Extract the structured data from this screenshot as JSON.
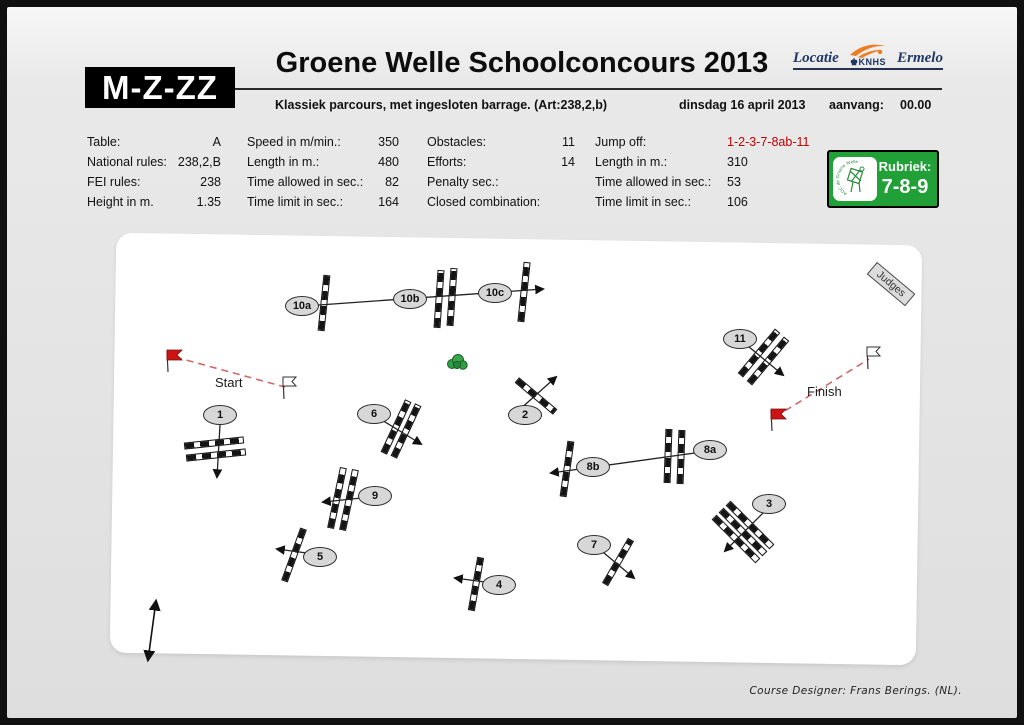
{
  "header": {
    "class_box": "M-Z-ZZ",
    "title": "Groene Welle Schoolconcours 2013",
    "location": {
      "prefix": "Locatie",
      "org": "KNHS",
      "city": "Ermelo"
    },
    "subtitle": "Klassiek parcours, met ingesloten barrage. (Art:238,2,b)",
    "date": "dinsdag 16 april 2013",
    "start_time_label": "aanvang:",
    "start_time_value": "00.00"
  },
  "info_table": {
    "columns": [
      {
        "rows": [
          {
            "label": "Table:",
            "value": "A"
          },
          {
            "label": "National rules:",
            "value": "238,2,B"
          },
          {
            "label": "FEI rules:",
            "value": "238"
          },
          {
            "label": "Height in m.",
            "value": "1.35"
          }
        ]
      },
      {
        "rows": [
          {
            "label": "Speed in m/min.:",
            "value": "350"
          },
          {
            "label": "Length in m.:",
            "value": "480"
          },
          {
            "label": "Time allowed in sec.:",
            "value": "82"
          },
          {
            "label": "Time limit in sec.:",
            "value": "164"
          }
        ]
      },
      {
        "rows": [
          {
            "label": "Obstacles:",
            "value": "11"
          },
          {
            "label": "Efforts:",
            "value": "14"
          },
          {
            "label": "Penalty sec.:",
            "value": ""
          },
          {
            "label": "Closed combination:",
            "value": ""
          }
        ]
      },
      {
        "rows": [
          {
            "label": "Jump off:",
            "value": "1-2-3-7-8ab-11"
          },
          {
            "label": "Length in m.:",
            "value": "310"
          },
          {
            "label": "Time allowed in sec.:",
            "value": "53"
          },
          {
            "label": "Time limit in sec.:",
            "value": "106"
          }
        ]
      }
    ]
  },
  "rubriek_badge": {
    "label": "Rubriek:",
    "value": "7-8-9",
    "logo_text": "AOC de Groene Welle"
  },
  "course": {
    "judges_label": "Judges",
    "start_label": "Start",
    "finish_label": "Finish",
    "jumps": [
      {
        "id": "1",
        "label": "1"
      },
      {
        "id": "2",
        "label": "2"
      },
      {
        "id": "3",
        "label": "3"
      },
      {
        "id": "4",
        "label": "4"
      },
      {
        "id": "5",
        "label": "5"
      },
      {
        "id": "6",
        "label": "6"
      },
      {
        "id": "7",
        "label": "7"
      },
      {
        "id": "8a",
        "label": "8a"
      },
      {
        "id": "8b",
        "label": "8b"
      },
      {
        "id": "9",
        "label": "9"
      },
      {
        "id": "10a",
        "label": "10a"
      },
      {
        "id": "10b",
        "label": "10b"
      },
      {
        "id": "10c",
        "label": "10c"
      },
      {
        "id": "11",
        "label": "11"
      }
    ]
  },
  "footer": {
    "credit": "Course Designer: Frans Berings. (NL)."
  },
  "colors": {
    "jump_off_red": "#C00000",
    "badge_green": "#21A038",
    "flag_red": "#CC1414",
    "knhs_orange": "#ED7D23",
    "navy": "#1F3864",
    "dashed_line": "#CC6A6A"
  }
}
